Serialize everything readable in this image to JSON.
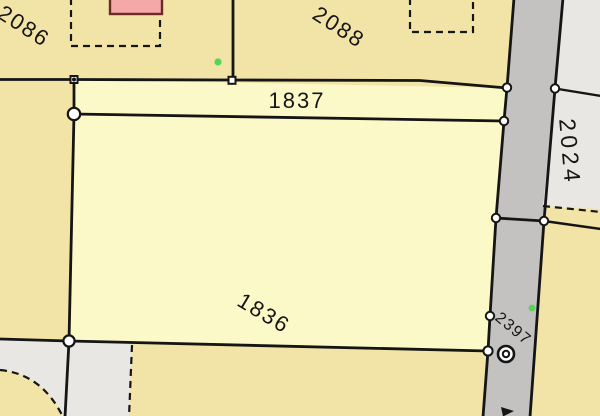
{
  "parcels": {
    "p2086": {
      "label": "2086"
    },
    "p2088": {
      "label": "2088"
    },
    "p1837": {
      "label": "1837"
    },
    "p1836": {
      "label": "1836"
    },
    "p2024": {
      "label": "2024"
    },
    "p2397": {
      "label": "2397"
    }
  },
  "icons": {
    "survey_monument": "double-circle-icon",
    "boundary_vertex": "white-dot-icon",
    "boundary_node": "white-square-icon",
    "control_point": "green-dot-icon"
  },
  "colors": {
    "parcel_tan": "#f2e3a6",
    "parcel_yellow": "#fcf9c8",
    "road_gray": "#c3c2c0",
    "adjacent_gray": "#e8e7e4",
    "building_pink": "#f5a8a8",
    "building_outline": "#6b2a2a",
    "boundary_black": "#151515",
    "vertex_white": "#ffffff",
    "control_green": "#55d655"
  }
}
